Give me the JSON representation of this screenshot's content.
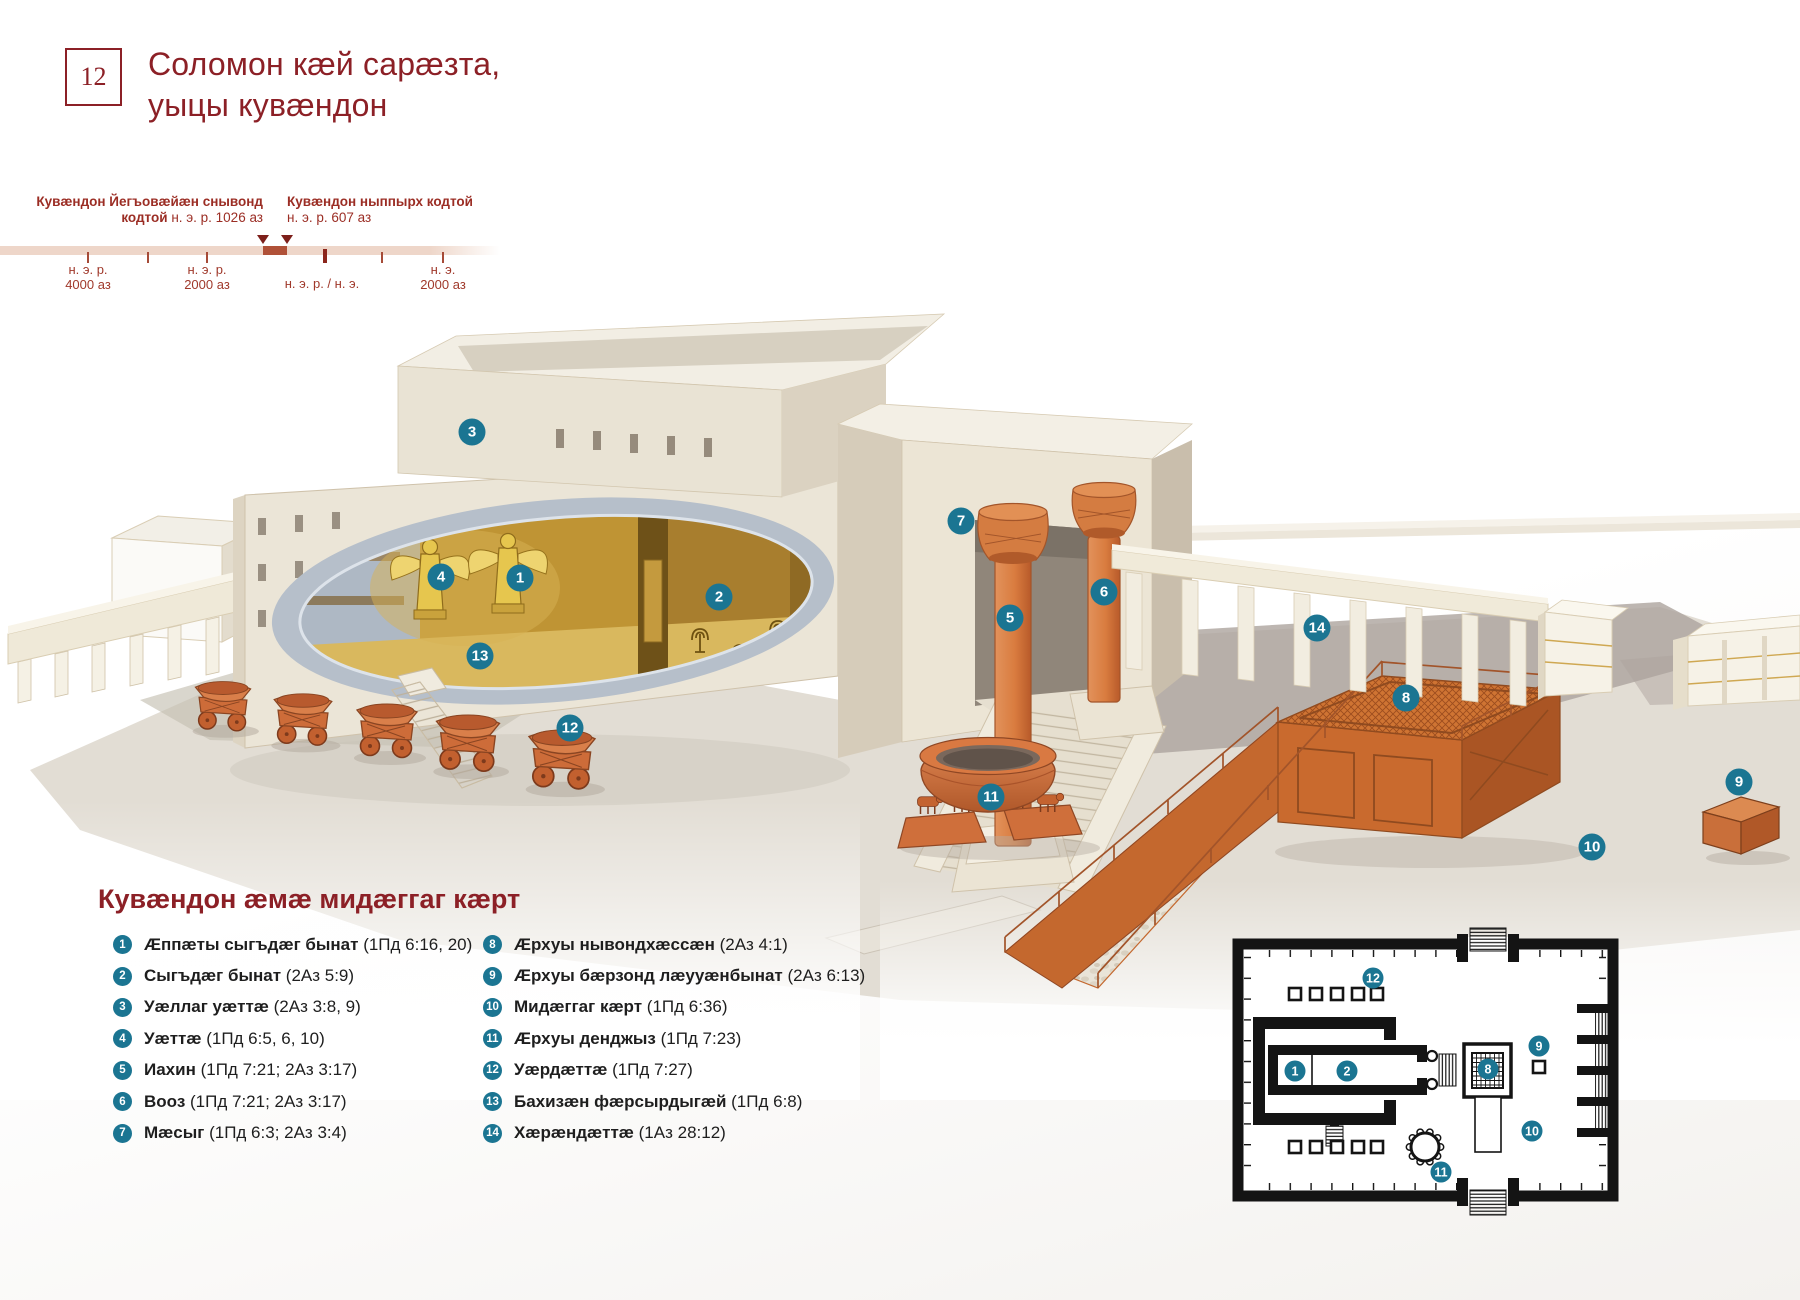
{
  "page": {
    "number": "12",
    "title_line1": "Соломон кæй сарæзта,",
    "title_line2": "уыцы кувæндон"
  },
  "timeline": {
    "event1": {
      "bold": "Кувæндон Йегъовæйæн снывонд",
      "bold2": "кодтой",
      "rest": "н. э. р. 1026 аз"
    },
    "event2": {
      "bold": "Кувæндон ныппырх кодтой",
      "rest": "н. э. р. 607 аз"
    },
    "axis": [
      {
        "l1": "н. э. р.",
        "l2": "4000 аз"
      },
      {
        "l1": "н. э. р.",
        "l2": "2000 аз"
      },
      {
        "l1": "н. э. р. / н. э.",
        "l2": ""
      },
      {
        "l1": "н. э.",
        "l2": "2000 аз"
      }
    ]
  },
  "legend": {
    "title": "Кувæндон æмæ мидæггаг кæрт",
    "items": [
      {
        "n": "1",
        "name": "Æппæты сыгъдæг бынат",
        "ref": "(1Пд 6:16, 20)"
      },
      {
        "n": "2",
        "name": "Сыгъдæг бынат",
        "ref": "(2Аз 5:9)"
      },
      {
        "n": "3",
        "name": "Уæллаг уæттæ",
        "ref": "(2Аз 3:8, 9)"
      },
      {
        "n": "4",
        "name": "Уæттæ",
        "ref": "(1Пд 6:5, 6, 10)"
      },
      {
        "n": "5",
        "name": "Иахин",
        "ref": "(1Пд 7:21; 2Аз 3:17)"
      },
      {
        "n": "6",
        "name": "Вооз",
        "ref": "(1Пд 7:21; 2Аз 3:17)"
      },
      {
        "n": "7",
        "name": "Мæсыг",
        "ref": "(1Пд 6:3; 2Аз 3:4)"
      },
      {
        "n": "8",
        "name": "Æрхуы нывондхæссæн",
        "ref": "(2Аз 4:1)"
      },
      {
        "n": "9",
        "name": "Æрхуы бæрзонд лæууæнбынат",
        "ref": "(2Аз 6:13)"
      },
      {
        "n": "10",
        "name": "Мидæггаг кæрт",
        "ref": "(1Пд 6:36)"
      },
      {
        "n": "11",
        "name": "Æрхуы денджыз",
        "ref": "(1Пд 7:23)"
      },
      {
        "n": "12",
        "name": "Уæрдæттæ",
        "ref": "(1Пд 7:27)"
      },
      {
        "n": "13",
        "name": "Бахизæн фæрсырдыгæй",
        "ref": "(1Пд 6:8)"
      },
      {
        "n": "14",
        "name": "Хæрæндæттæ",
        "ref": "(1Аз 28:12)"
      }
    ]
  },
  "markers": {
    "illustration": [
      {
        "n": "1",
        "x": 520,
        "y": 578
      },
      {
        "n": "2",
        "x": 719,
        "y": 597
      },
      {
        "n": "3",
        "x": 472,
        "y": 432
      },
      {
        "n": "4",
        "x": 441,
        "y": 577
      },
      {
        "n": "5",
        "x": 1010,
        "y": 618
      },
      {
        "n": "6",
        "x": 1104,
        "y": 592
      },
      {
        "n": "7",
        "x": 961,
        "y": 521
      },
      {
        "n": "8",
        "x": 1406,
        "y": 698
      },
      {
        "n": "9",
        "x": 1739,
        "y": 782
      },
      {
        "n": "10",
        "x": 1592,
        "y": 847
      },
      {
        "n": "11",
        "x": 991,
        "y": 797
      },
      {
        "n": "12",
        "x": 570,
        "y": 728
      },
      {
        "n": "13",
        "x": 480,
        "y": 656
      },
      {
        "n": "14",
        "x": 1317,
        "y": 628
      }
    ],
    "floorplan": [
      {
        "n": "1",
        "x": 1295,
        "y": 1071
      },
      {
        "n": "2",
        "x": 1347,
        "y": 1071
      },
      {
        "n": "8",
        "x": 1488,
        "y": 1069
      },
      {
        "n": "9",
        "x": 1539,
        "y": 1046
      },
      {
        "n": "10",
        "x": 1532,
        "y": 1131
      },
      {
        "n": "11",
        "x": 1441,
        "y": 1172
      },
      {
        "n": "12",
        "x": 1373,
        "y": 978
      }
    ]
  },
  "colors": {
    "badge": "#1b7592",
    "accent": "#8c2026"
  }
}
